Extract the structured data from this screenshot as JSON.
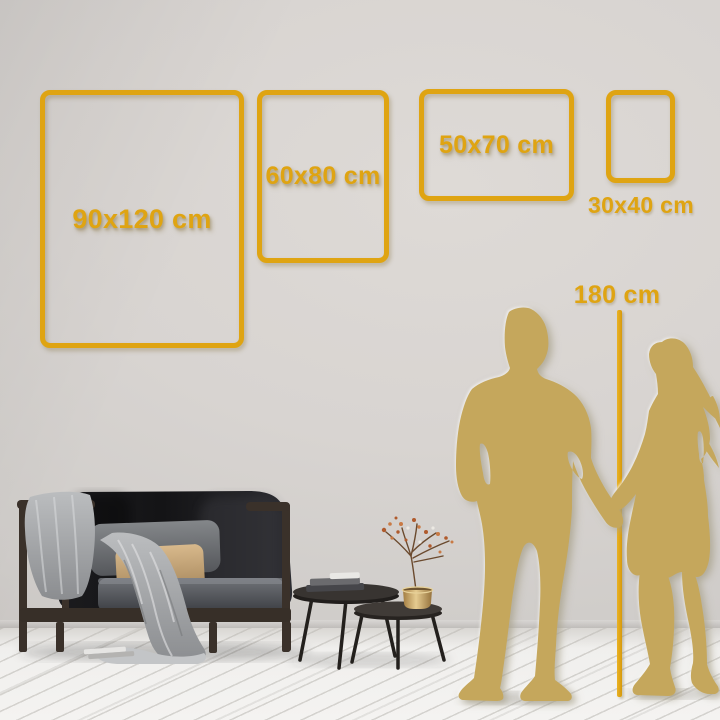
{
  "scene": {
    "title": "Wall art size comparison guide",
    "frames": [
      {
        "id": "90x120",
        "size_label": "90x120 cm"
      },
      {
        "id": "60x80",
        "size_label": "60x80 cm"
      },
      {
        "id": "50x70",
        "size_label": "50x70 cm"
      },
      {
        "id": "30x40",
        "size_label": "30x40 cm"
      }
    ],
    "height_reference": {
      "label": "180 cm"
    },
    "colors": {
      "accent_gold": "#DFA412",
      "silhouette_gold": "#C5A75C",
      "wall": "#D7D3D0",
      "floor": "#F2F1EF"
    }
  }
}
